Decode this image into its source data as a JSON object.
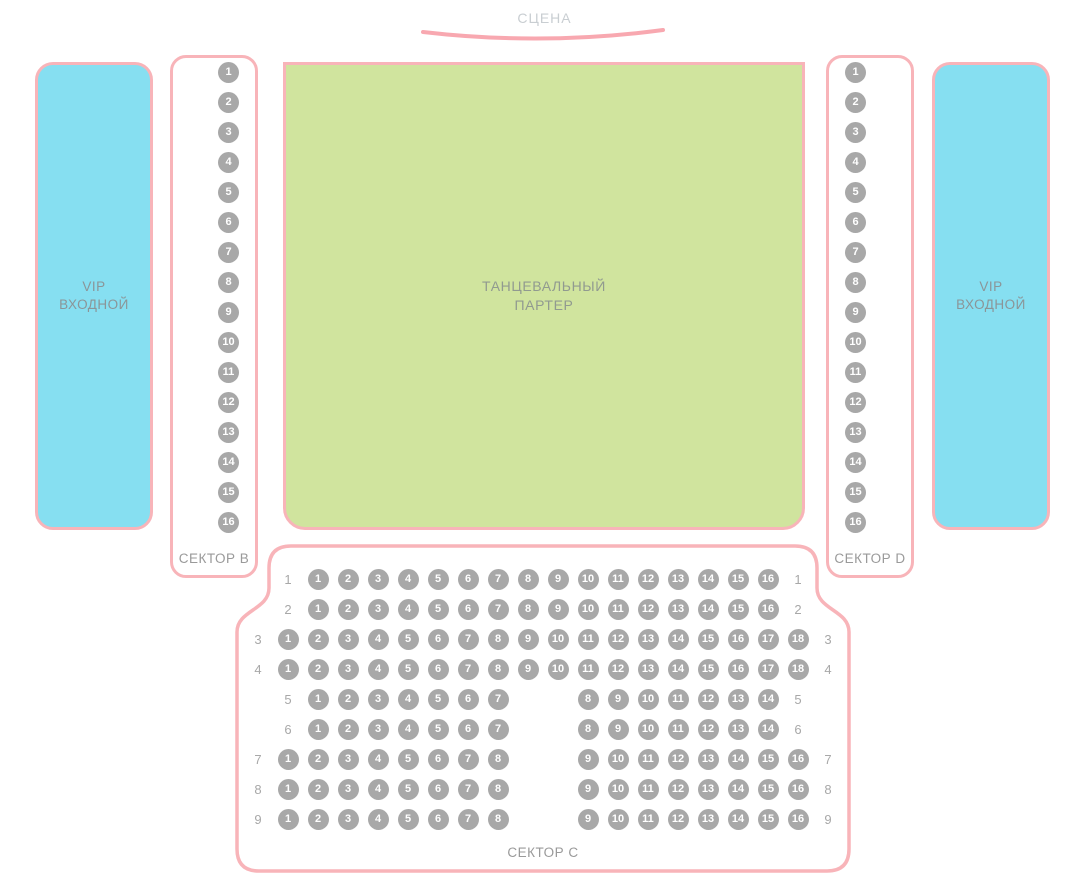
{
  "stage": {
    "label": "СЦЕНА"
  },
  "dance_floor": {
    "line1": "ТАНЦЕВАЛЬНЫЙ",
    "line2": "ПАРТЕР"
  },
  "vip_left": {
    "line1": "VIP",
    "line2": "ВХОДНОЙ"
  },
  "vip_right": {
    "line1": "VIP",
    "line2": "ВХОДНОЙ"
  },
  "sector_b": {
    "label": "СЕКТОР B",
    "seats": [
      1,
      2,
      3,
      4,
      5,
      6,
      7,
      8,
      9,
      10,
      11,
      12,
      13,
      14,
      15,
      16
    ]
  },
  "sector_d": {
    "label": "СЕКТОР D",
    "seats": [
      1,
      2,
      3,
      4,
      5,
      6,
      7,
      8,
      9,
      10,
      11,
      12,
      13,
      14,
      15,
      16
    ]
  },
  "sector_c": {
    "label": "СЕКТОР C",
    "rows": [
      {
        "label": "1",
        "slots": [
          1,
          2,
          3,
          4,
          5,
          6,
          7,
          8,
          9,
          10,
          11,
          12,
          13,
          14,
          15,
          16
        ]
      },
      {
        "label": "2",
        "slots": [
          1,
          2,
          3,
          4,
          5,
          6,
          7,
          8,
          9,
          10,
          11,
          12,
          13,
          14,
          15,
          16
        ]
      },
      {
        "label": "3",
        "slots": [
          1,
          2,
          3,
          4,
          5,
          6,
          7,
          8,
          9,
          10,
          11,
          12,
          13,
          14,
          15,
          16,
          17,
          18
        ]
      },
      {
        "label": "4",
        "slots": [
          1,
          2,
          3,
          4,
          5,
          6,
          7,
          8,
          9,
          10,
          11,
          12,
          13,
          14,
          15,
          16,
          17,
          18
        ]
      },
      {
        "label": "5",
        "slots": [
          1,
          2,
          3,
          4,
          5,
          6,
          7,
          null,
          null,
          8,
          9,
          10,
          11,
          12,
          13,
          14
        ]
      },
      {
        "label": "6",
        "slots": [
          1,
          2,
          3,
          4,
          5,
          6,
          7,
          null,
          null,
          8,
          9,
          10,
          11,
          12,
          13,
          14
        ]
      },
      {
        "label": "7",
        "slots": [
          1,
          2,
          3,
          4,
          5,
          6,
          7,
          8,
          null,
          null,
          9,
          10,
          11,
          12,
          13,
          14,
          15,
          16
        ]
      },
      {
        "label": "8",
        "slots": [
          1,
          2,
          3,
          4,
          5,
          6,
          7,
          8,
          null,
          null,
          9,
          10,
          11,
          12,
          13,
          14,
          15,
          16
        ]
      },
      {
        "label": "9",
        "slots": [
          1,
          2,
          3,
          4,
          5,
          6,
          7,
          8,
          null,
          null,
          9,
          10,
          11,
          12,
          13,
          14,
          15,
          16
        ]
      }
    ]
  },
  "colors": {
    "border_pink": "#f8b4b9",
    "stage_arc": "#f8a8b0",
    "vip_fill": "#86dff1",
    "dance_fill": "#d0e49e",
    "seat_fill": "#a8a8a8",
    "seat_text": "#ffffff",
    "zone_text": "#8b9598",
    "label_gray": "#9a9a9a",
    "row_label_gray": "#a8a8a8",
    "stage_text": "#c9ced2"
  }
}
